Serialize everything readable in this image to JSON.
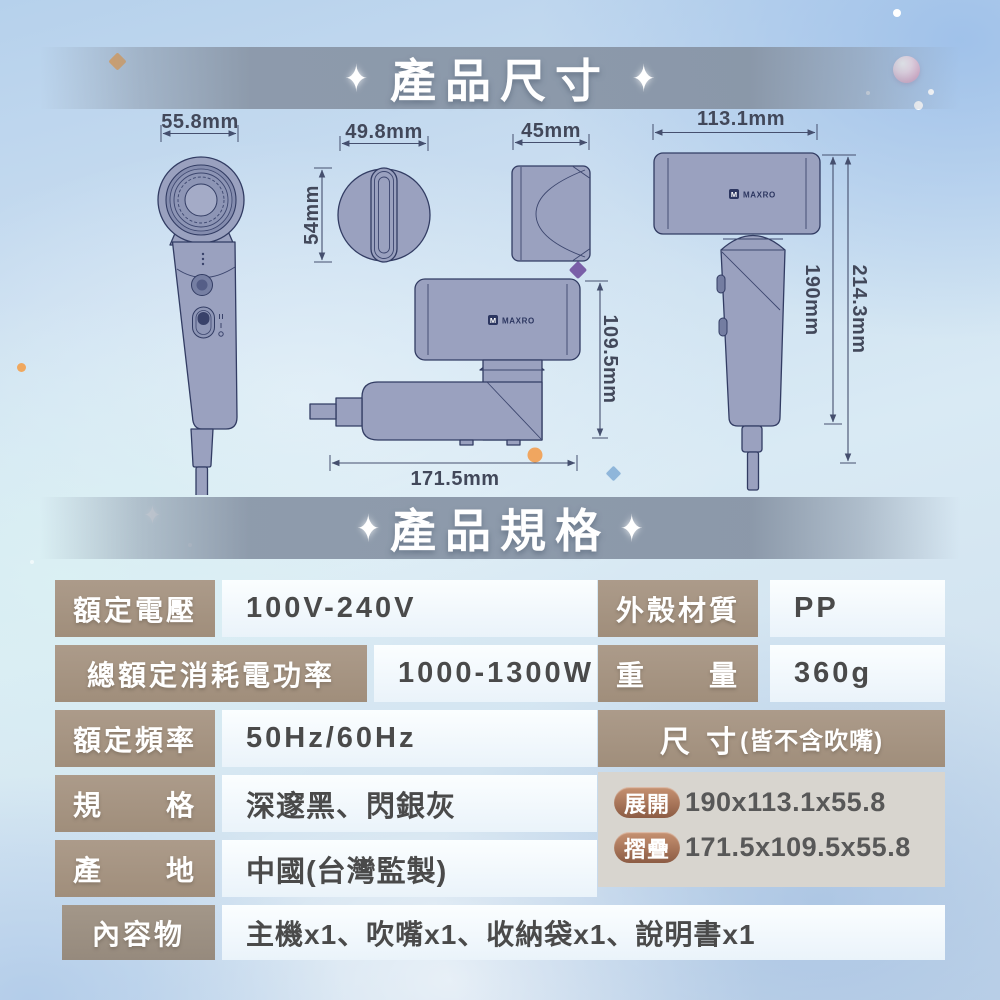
{
  "sections": {
    "dimensions_title": "產品尺寸",
    "specs_title": "產品規格",
    "sparkle": "✦"
  },
  "brand": {
    "logo_mark": "M",
    "logo_text": "MAXRO"
  },
  "dimension_labels": {
    "front_width": "55.8mm",
    "head_width": "49.8mm",
    "head_depth": "54mm",
    "nozzle_width": "45mm",
    "unfolded_width": "113.1mm",
    "unfolded_body_length": "190mm",
    "unfolded_total_length": "214.3mm",
    "folded_height": "109.5mm",
    "folded_length": "171.5mm"
  },
  "spec_table": {
    "rows_left": [
      {
        "label": "額定電壓",
        "value": "100V-240V"
      },
      {
        "label": "總額定消耗電功率",
        "value": "1000-1300W"
      },
      {
        "label": "額定頻率",
        "value": "50Hz/60Hz"
      },
      {
        "label": "規　　格",
        "value": "深邃黑、閃銀灰"
      },
      {
        "label": "產　　地",
        "value": "中國(台灣監製)"
      }
    ],
    "rows_right": [
      {
        "label": "外殼材質",
        "value": "PP"
      },
      {
        "label": "重　　量",
        "value": "360g"
      }
    ],
    "size": {
      "header_main": "尺 寸",
      "header_note": "(皆不含吹嘴)",
      "unfolded_tag": "展開",
      "unfolded_value": "190x113.1x55.8",
      "folded_tag": "摺疊",
      "folded_value": "171.5x109.5x55.8"
    },
    "contents": {
      "label": "內容物",
      "value": "主機x1、吹嘴x1、收納袋x1、說明書x1"
    }
  },
  "colors": {
    "label_bg": "#a6947f",
    "value_text": "#4a4a4a",
    "size_box_bg": "#d8d5cf",
    "pill_brown": "#a06a4e",
    "product_fill": "#9aa1bf",
    "product_outline": "#323c63",
    "dim_line": "#454f6e",
    "title_band": "#8b98a9",
    "accent_orange": "#efa24d",
    "accent_purple": "#7a5fa8",
    "accent_blue": "#8fb6da",
    "pearl_pink": "#dcaecb"
  }
}
